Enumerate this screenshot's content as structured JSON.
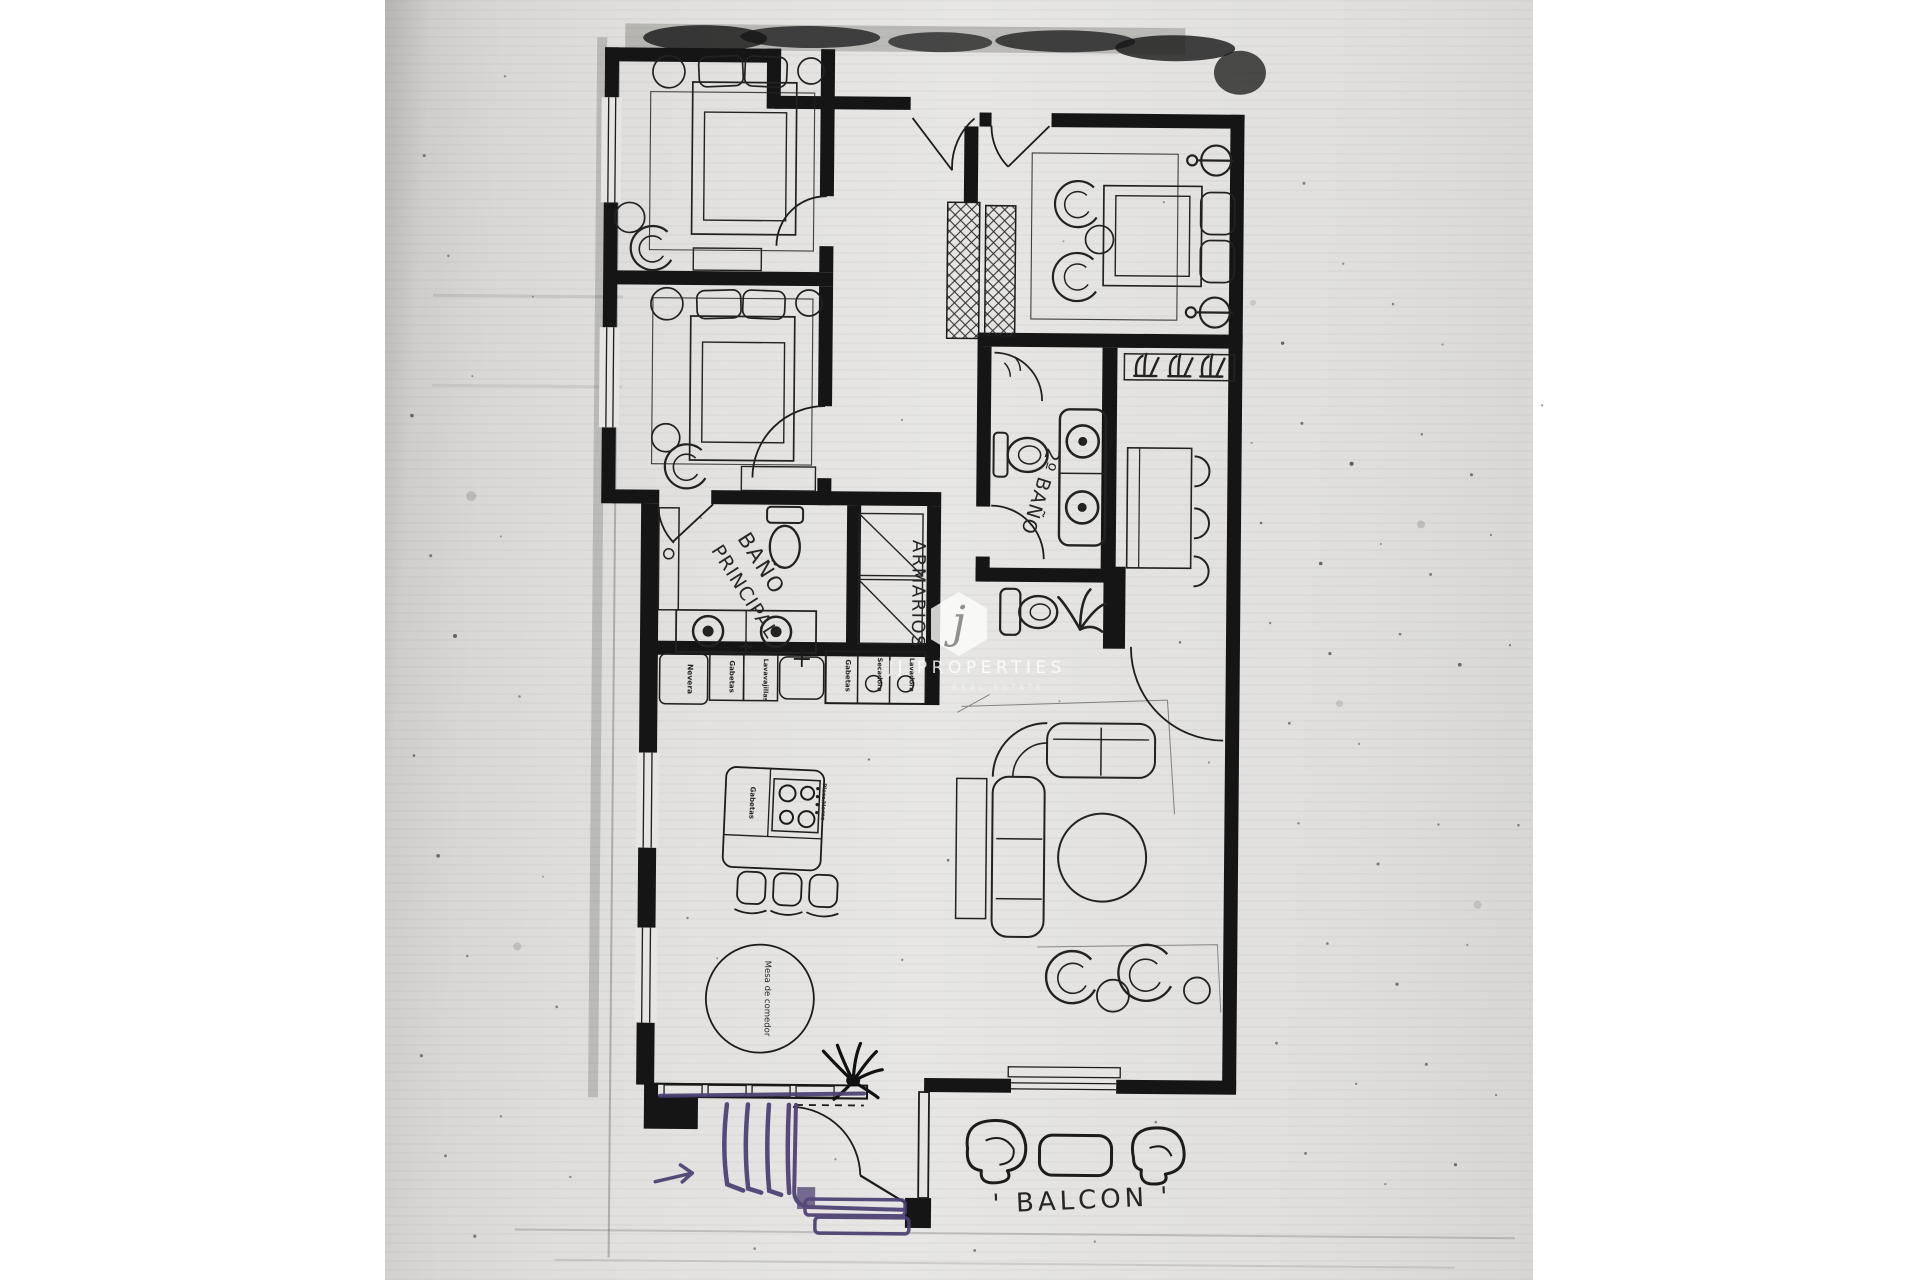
{
  "watermark": {
    "logo_letter": "j",
    "brand": "JJ PROPERTIES",
    "tagline": "REAL ESTATE"
  },
  "floorplan": {
    "labels": {
      "master_bath_line1": "BAÑO",
      "master_bath_line2": "PRINCIPAL",
      "wardrobes": "ARMARIOS",
      "second_bath": "2º BAÑO",
      "balcony": "' BALCON '",
      "dining_table": "Mesa de comedor"
    },
    "kitchen": {
      "counter_units": [
        "Nevera",
        "Gabetas",
        "Lavavajillas",
        "Gabetas",
        "Secadora",
        "Lavadora"
      ],
      "island_units": [
        "Gabetas",
        "Placa/Horno"
      ]
    },
    "annotation_colors": {
      "pen_purple": "#4b3e72",
      "ink_black": "#1c1c1c"
    }
  }
}
